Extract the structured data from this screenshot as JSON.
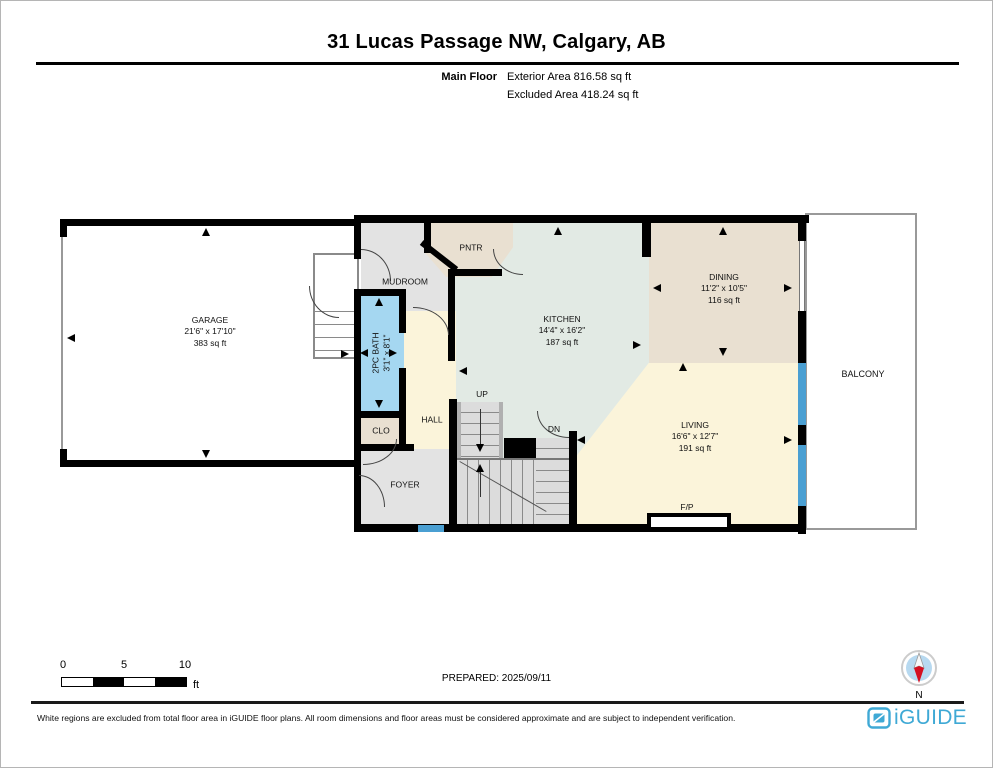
{
  "header": {
    "title": "31 Lucas Passage NW, Calgary, AB",
    "floor_label": "Main Floor",
    "exterior_area": "Exterior Area 816.58 sq ft",
    "excluded_area": "Excluded Area 418.24 sq ft"
  },
  "rooms": [
    {
      "name": "GARAGE",
      "dimensions": "21'6\" x 17'10\"",
      "area": "383 sq ft"
    },
    {
      "name": "MUDROOM"
    },
    {
      "name": "PNTR"
    },
    {
      "name": "2PC BATH",
      "dimensions": "3'1\" x 8'1\""
    },
    {
      "name": "KITCHEN",
      "dimensions": "14'4\" x 16'2\"",
      "area": "187 sq ft"
    },
    {
      "name": "DINING",
      "dimensions": "11'2\" x 10'5\"",
      "area": "116 sq ft"
    },
    {
      "name": "LIVING",
      "dimensions": "16'6\" x 12'7\"",
      "area": "191 sq ft"
    },
    {
      "name": "HALL"
    },
    {
      "name": "CLO"
    },
    {
      "name": "FOYER"
    },
    {
      "name": "BALCONY"
    }
  ],
  "plan_labels": {
    "up": "UP",
    "dn": "DN",
    "fireplace": "F/P"
  },
  "scale_bar": {
    "ticks": [
      "0",
      "5",
      "10"
    ],
    "unit": "ft"
  },
  "prepared_label": "PREPARED: 2025/09/11",
  "compass": {
    "label": "N"
  },
  "footer": {
    "disclaimer": "White regions are excluded from total floor area in iGUIDE floor plans. All room dimensions and floor areas must be considered approximate and are subject to independent verification.",
    "brand": "iGUIDE"
  },
  "colors": {
    "wall": "#000000",
    "kitchen_fill": "#e2eae4",
    "dining_fill": "#e9e0d1",
    "living_fill": "#fbf4da",
    "mudroom_fill": "#e3e3e3",
    "bath_fill": "#a5d7f1",
    "window_blue": "#4a9fd2",
    "stair_fill": "#dcdcdc",
    "brand_blue": "#3FA9D5",
    "compass_red": "#d40f20"
  }
}
